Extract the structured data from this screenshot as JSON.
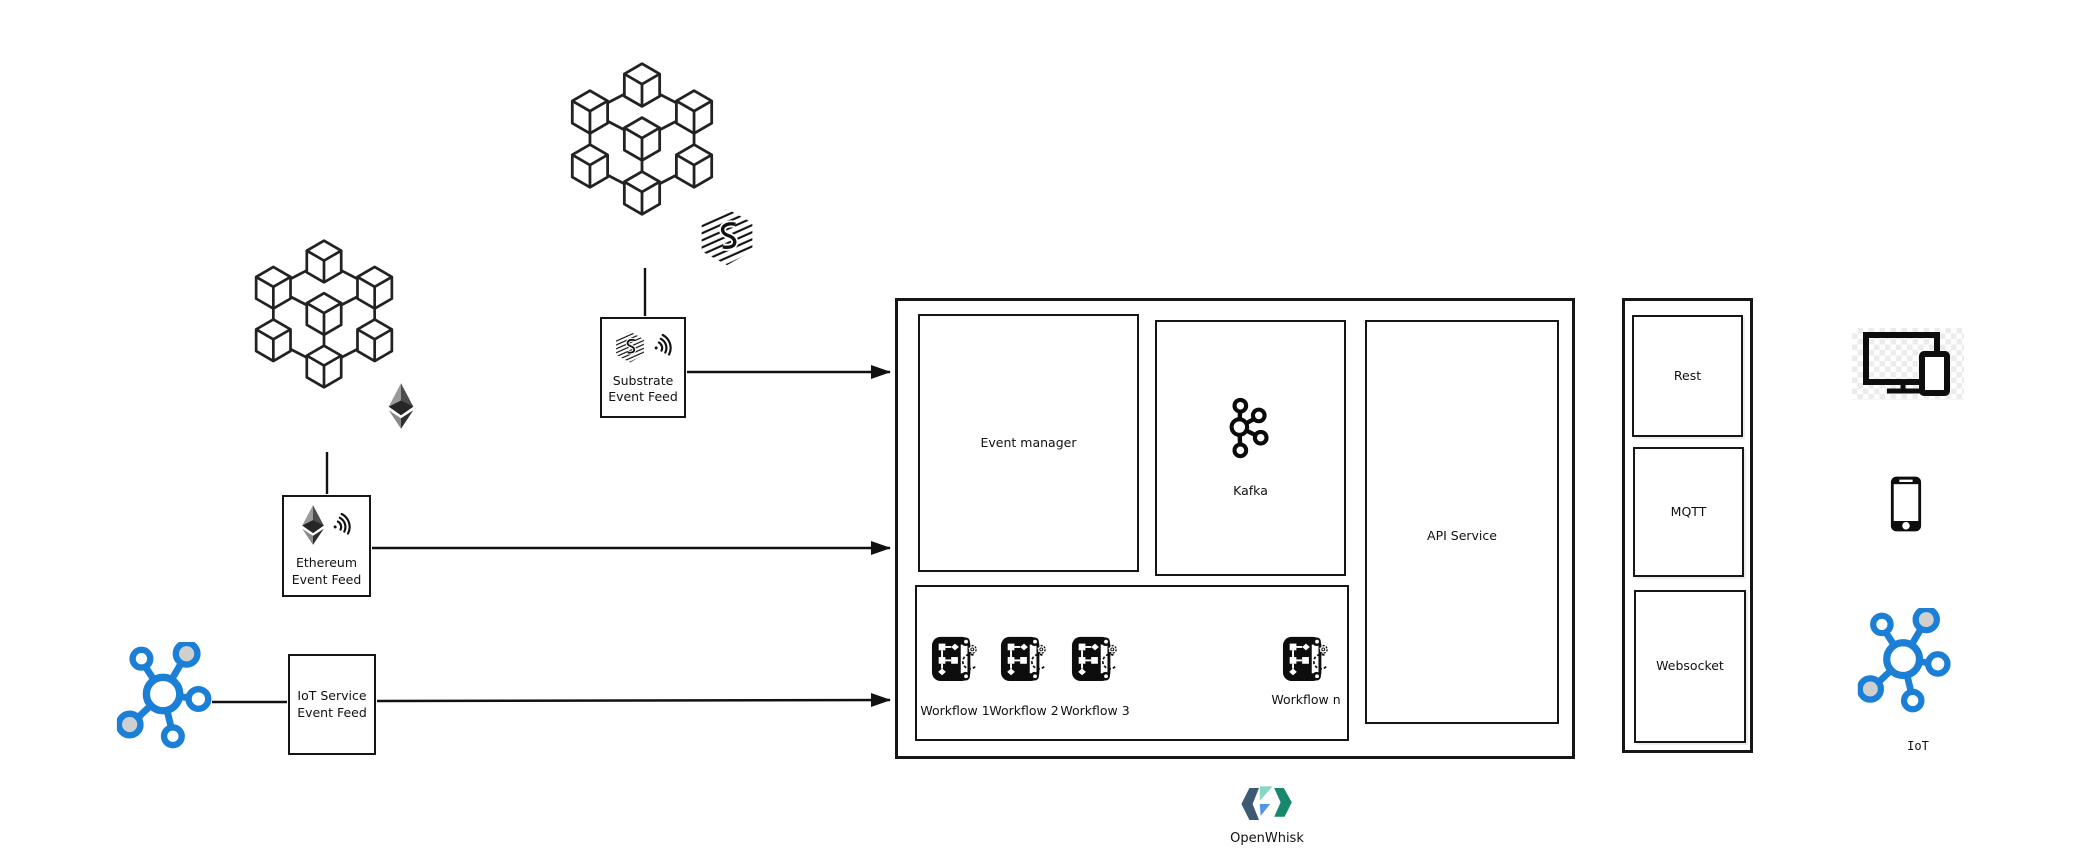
{
  "diagram": {
    "feeds": {
      "substrate": {
        "line1": "Substrate",
        "line2": "Event Feed"
      },
      "ethereum": {
        "line1": "Ethereum",
        "line2": "Event Feed"
      },
      "iot": {
        "line1": "IoT Service",
        "line2": "Event Feed"
      }
    },
    "core": {
      "event_manager": "Event manager",
      "kafka": "Kafka",
      "api_service": "API Service",
      "workflows": [
        "Workflow 1",
        "Workflow 2",
        "Workflow 3",
        "Workflow n"
      ]
    },
    "protocols": [
      "Rest",
      "MQTT",
      "Websocket"
    ],
    "clients": {
      "iot_label": "IoT"
    },
    "footer": {
      "platform": "OpenWhisk"
    },
    "icons": {
      "blockchain": "cube-network-icon",
      "substrate_logo": "substrate-hatched-hex-icon",
      "ethereum_logo": "ethereum-diamond-icon",
      "event_waves": "signal-waves-icon",
      "iot_hub": "iot-network-icon",
      "kafka_logo": "kafka-icon",
      "workflow": "workflow-script-gear-icon",
      "devices": "monitor-tablet-icon",
      "phone": "smartphone-icon",
      "openwhisk_logo": "openwhisk-logo"
    },
    "colors": {
      "line": "#161616",
      "iot_blue": "#1b7fd6",
      "node_gray": "#cfcfcf",
      "openwhisk_navy": "#3d5a73",
      "openwhisk_blue": "#4f96e8",
      "openwhisk_mint": "#85d8c1",
      "openwhisk_teal": "#18886c"
    }
  }
}
